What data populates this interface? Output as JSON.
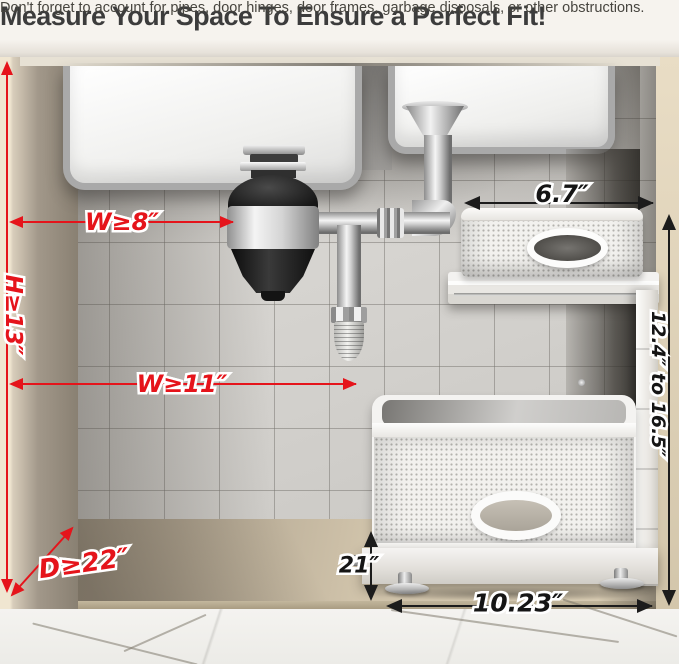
{
  "header": {
    "title": "Measure Your Space To Ensure a Perfect Fit!",
    "subtitle": "Don't forget to account for pipes, door hinges, door frames, garbage disposals, or other obstructions."
  },
  "measurements": {
    "disposal_width": "W≥8″",
    "cabinet_height": "H≥13″",
    "rack_width": "W≥11″",
    "cabinet_depth": "D≥22″",
    "upper_basket_width": "6.7″",
    "adjustable_height": "12.4″ to 16.5″",
    "lower_basket_depth": "21″",
    "lower_basket_width": "10.23″"
  },
  "colors": {
    "annotation_red": "#e5141b",
    "annotation_black": "#1c1c1c",
    "cabinet_beige": "#d5c9b2",
    "tile_gray": "#d5d3cf",
    "basket_white": "#f4f3f1"
  }
}
